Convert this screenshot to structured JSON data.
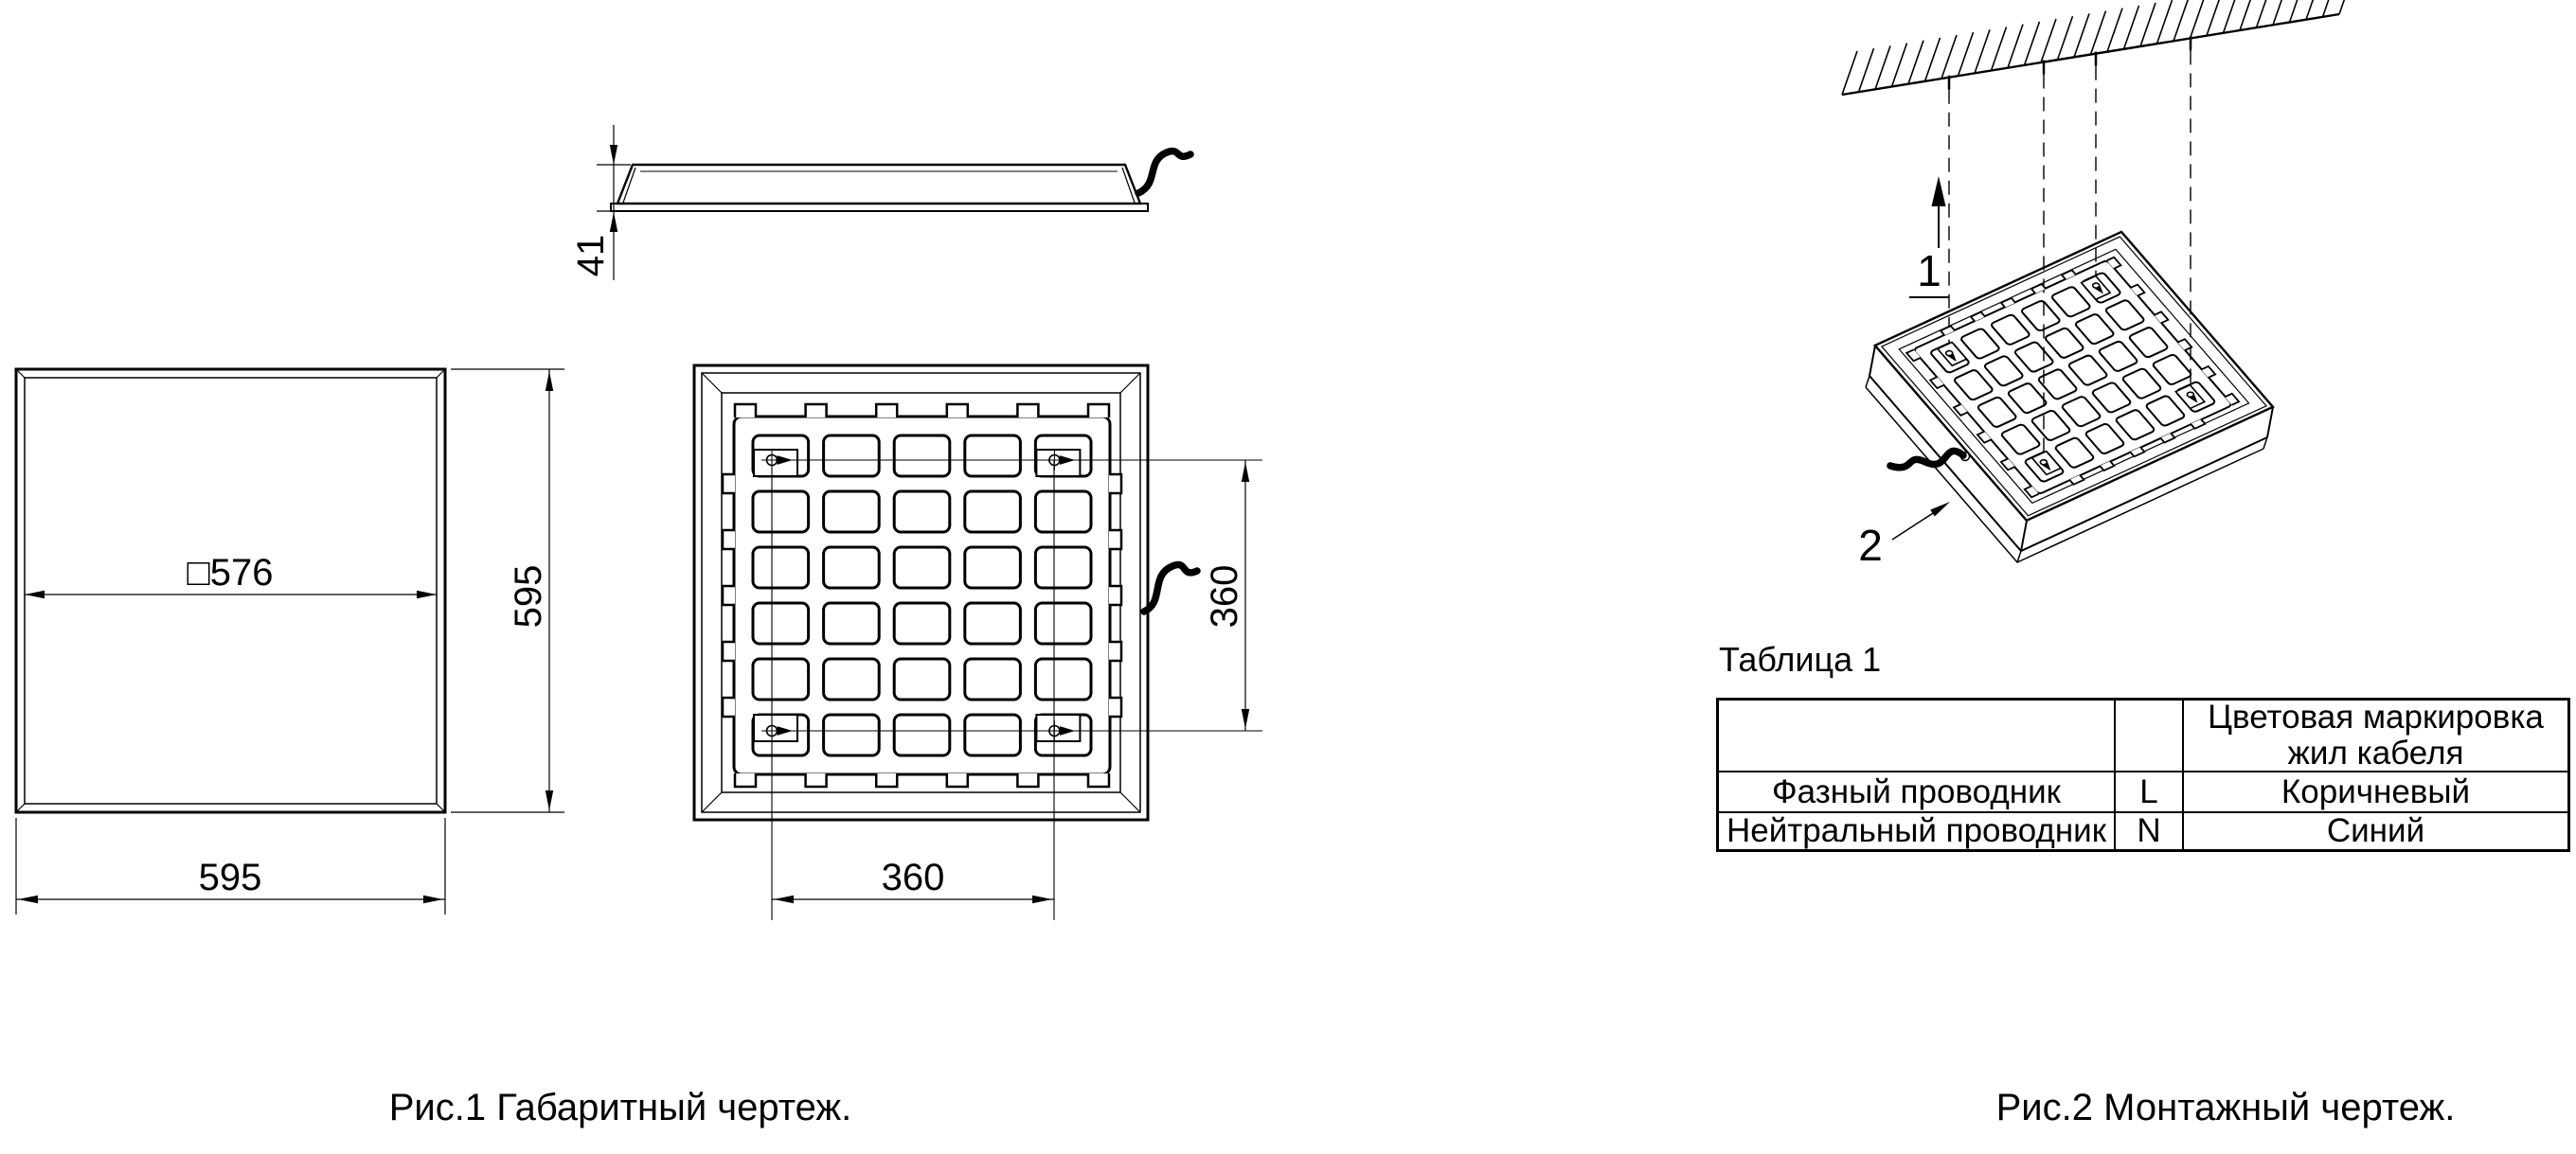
{
  "page": {
    "background": "#ffffff",
    "line_color": "#000000"
  },
  "figure1": {
    "caption": "Рис.1 Габаритный чертеж.",
    "front_view": {
      "inner_width_dim": "□576",
      "height_dim": "595",
      "width_dim": "595"
    },
    "profile_view": {
      "thickness_dim": "41"
    },
    "back_view": {
      "mount_v_dim": "360",
      "mount_h_dim": "360"
    }
  },
  "figure2": {
    "caption": "Рис.2 Монтажный чертеж.",
    "callout_lift": "1",
    "callout_cable": "2"
  },
  "table1": {
    "title": "Таблица 1",
    "header": {
      "col3_line1": "Цветовая маркировка",
      "col3_line2": "жил кабеля"
    },
    "rows": [
      {
        "name": "Фазный проводник",
        "terminal": "L",
        "color": "Коричневый"
      },
      {
        "name": "Нейтральный проводник",
        "terminal": "N",
        "color": "Синий"
      }
    ]
  },
  "drawing": {
    "grid": {
      "cols": 5,
      "rows": 6
    }
  }
}
